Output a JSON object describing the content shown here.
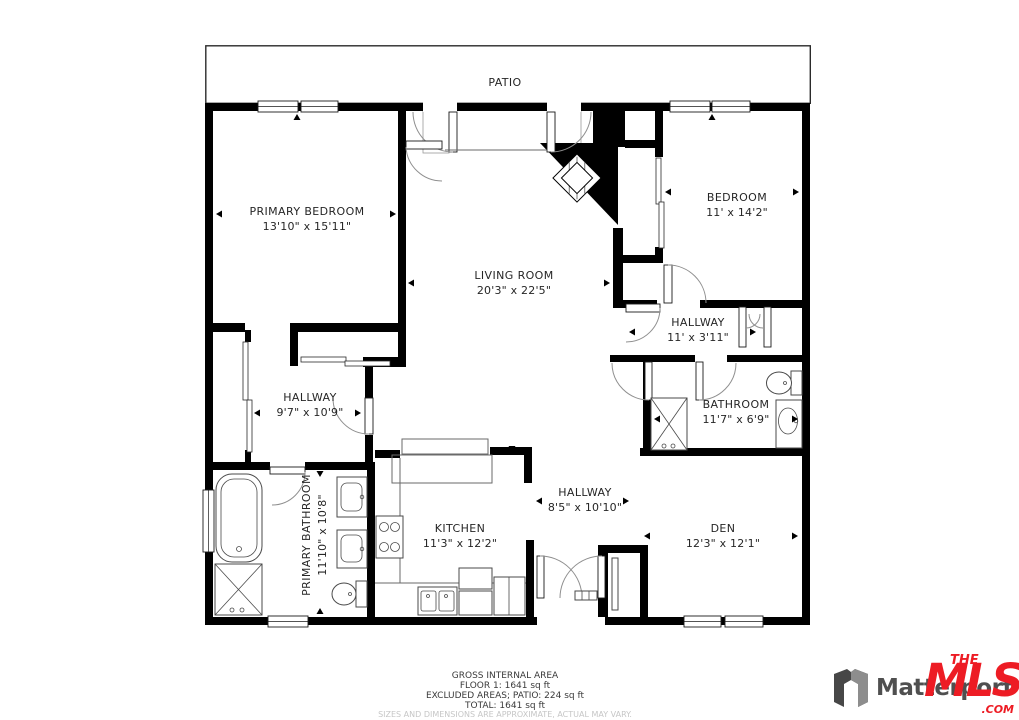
{
  "plan": {
    "patio_label": "PATIO",
    "rooms": [
      {
        "name": "PRIMARY BEDROOM",
        "dims": "13'10\" x 15'11\""
      },
      {
        "name": "BEDROOM",
        "dims": "11' x 14'2\""
      },
      {
        "name": "LIVING ROOM",
        "dims": "20'3\" x 22'5\""
      },
      {
        "name": "HALLWAY",
        "dims": "11' x 3'11\""
      },
      {
        "name": "HALLWAY",
        "dims": "9'7\" x 10'9\""
      },
      {
        "name": "BATHROOM",
        "dims": "11'7\" x 6'9\""
      },
      {
        "name": "PRIMARY BATHROOM",
        "dims": "11'10\" x 10'8\""
      },
      {
        "name": "KITCHEN",
        "dims": "11'3\" x 12'2\""
      },
      {
        "name": "HALLWAY",
        "dims": "8'5\" x 10'10\""
      },
      {
        "name": "DEN",
        "dims": "12'3\" x 12'1\""
      }
    ]
  },
  "footer": {
    "line1": "GROSS INTERNAL AREA",
    "line2": "FLOOR 1: 1641 sq ft",
    "line3": "EXCLUDED AREAS; PATIO: 224 sq ft",
    "line4": "TOTAL: 1641 sq ft",
    "disclaimer": "SIZES AND DIMENSIONS ARE APPROXIMATE, ACTUAL MAY VARY."
  },
  "branding": {
    "matterport_text": "Matterport",
    "mls_the": "THE",
    "mls_main": "MLS",
    "mls_tm": "™",
    "mls_com": ".COM"
  },
  "colors": {
    "wall": "#000000",
    "fixture_line": "#4a4a4a",
    "mls_red": "#ed1c24",
    "matterport_gray": "#4f4f4f",
    "disclaimer_gray": "#c6c6c6"
  }
}
